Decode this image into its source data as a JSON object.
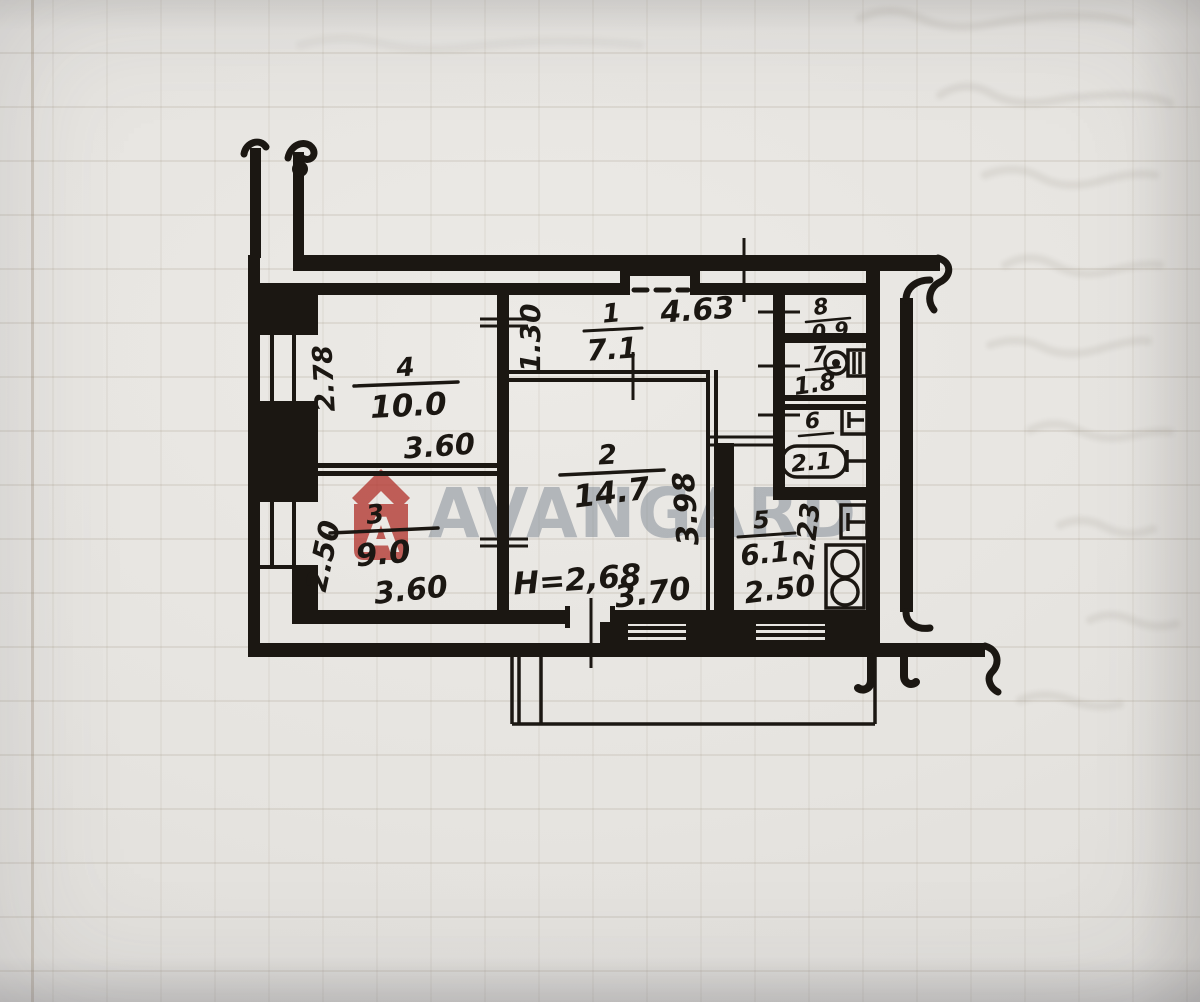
{
  "watermark": {
    "brand": "AVANGARD",
    "logo_letter": "A"
  },
  "plan": {
    "ceiling_height_label": "H=2,68",
    "rooms": {
      "r1": {
        "number": "1",
        "area": "7.1"
      },
      "r2": {
        "number": "2",
        "area": "14.7"
      },
      "r3": {
        "number": "3",
        "area": "9.0"
      },
      "r4": {
        "number": "4",
        "area": "10.0"
      },
      "r5": {
        "number": "5",
        "area": "6.1"
      },
      "r6": {
        "number": "6",
        "area": "2.1"
      },
      "r7": {
        "number": "7",
        "area": "1.8"
      },
      "r8": {
        "number": "8",
        "area": "0.9"
      }
    },
    "dimensions": {
      "hall_width": "4.63",
      "hall_depth": "1.30",
      "room4_depth": "2.78",
      "room4_width": "3.60",
      "room3_depth": "2.50",
      "room3_width": "3.60",
      "room2_depth": "3.98",
      "room2_width": "3.70",
      "kitchen_depth": "2.23",
      "kitchen_width": "2.50"
    }
  },
  "colors": {
    "ink": "#1b1712",
    "paper": "#e7e5e1",
    "watermark_text": "#7b8490",
    "watermark_logo": "#b23730"
  }
}
